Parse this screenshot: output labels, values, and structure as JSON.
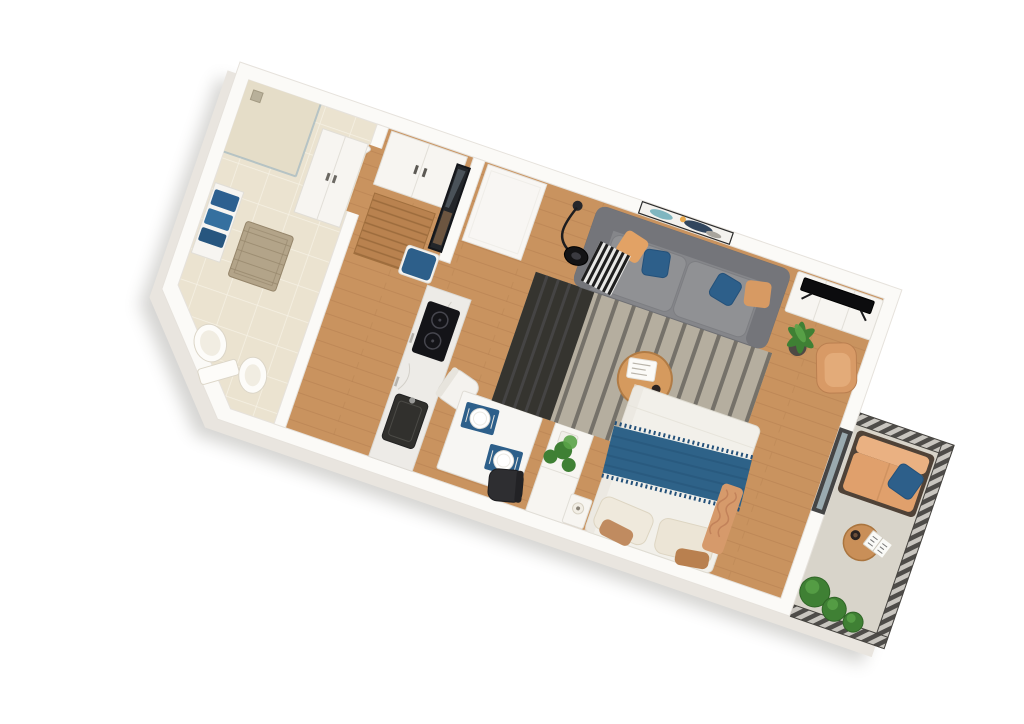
{
  "scene": {
    "description": "3D isometric floor plan render of a studio apartment with balcony",
    "rotation_deg": 19
  },
  "colors": {
    "page_bg": "#ffffff",
    "wall": "#fbfaf7",
    "wall_edge": "#e6e2dc",
    "wall_side": "#e9e5df",
    "wood": "#c9935f",
    "wood_dark": "#b17a4e",
    "tile": "#ebe3d0",
    "tile_line": "#f6f1e4",
    "shower": "#e5ddc8",
    "glass": "#a9bcc2",
    "rug_base": "#b5ae9f",
    "rug_stripe": "#6a665f",
    "rug_dark": "#35342f",
    "sofa": "#85868a",
    "sofa_dark": "#74757a",
    "seat": "#909194",
    "pillow_blue": "#2d5f8a",
    "pillow_orange": "#e2a265",
    "bed_white": "#f2f0ea",
    "pillow_beige": "#efe9dc",
    "pillow_brown": "#c08b60",
    "throw_blue": "#2e6288",
    "knit_tan": "#d69a6b",
    "tv_black": "#0c0c0e",
    "console_white": "#f7f5f1",
    "marble": "#edebe7",
    "cooktop": "#141418",
    "sink": "#31302d",
    "fridge": "#f8f6f3",
    "table_white": "#f7f6f3",
    "chair_black": "#2e2e31",
    "placemat_blue": "#2d5f8a",
    "mirror": "#23262a",
    "cushion_blue": "#2d5f8a",
    "mat_wood": "#b9824f",
    "mat_line": "#9c6b3c",
    "basket": "#b3a489",
    "towel_blue": "#2d6090",
    "balcony_floor": "#d8d4ca",
    "rail_dark": "#4e4c49",
    "rail_light": "#c9c6c0",
    "outdoor_sofa": "#e0a06c",
    "outdoor_back": "#eab182",
    "outdoor_frame": "#4f4237",
    "plant": "#3f8034",
    "plant_light": "#5aa348",
    "pot": "#4e4a44",
    "art_teal": "#7fb6c0",
    "art_navy": "#31465e",
    "art_orange": "#e8a94e",
    "art_gray": "#a8a49c",
    "lamp_black": "#131315",
    "door_frame": "#454545",
    "coffee_wood": "#d59a5e"
  },
  "rooms": {
    "bathroom": {
      "items": [
        "shower",
        "towel-shelf",
        "blue-towels",
        "laundry-basket",
        "storage-cabinet",
        "toilet",
        "bidet",
        "bathroom-door"
      ]
    },
    "hallway": {
      "items": [
        "wardrobe",
        "wall-mirror",
        "bench-with-blue-cushion",
        "wooden-door-mat"
      ]
    },
    "kitchen": {
      "items": [
        "fridge-tall-unit",
        "marble-counter",
        "induction-cooktop",
        "kitchen-sink"
      ]
    },
    "living_dining": {
      "items": [
        "dining-table",
        "blue-placemats-with-plates",
        "white-chair",
        "black-chair",
        "striped-rug",
        "gray-sofa",
        "accent-pillows",
        "checkered-throw",
        "arc-floor-lamp",
        "abstract-wall-art",
        "round-coffee-table",
        "magazines-and-cup",
        "tall-potted-plant",
        "divider-cabinet-with-plant"
      ]
    },
    "sleeping_area": {
      "items": [
        "tv-console",
        "flat-tv",
        "tan-armchair",
        "double-bed",
        "blue-throw-blanket",
        "beige-pillows",
        "tan-knit-blanket",
        "nightstand",
        "table-lamp",
        "balcony-door"
      ]
    },
    "balcony": {
      "items": [
        "slatted-railing",
        "outdoor-sofa",
        "blue-outdoor-pillow",
        "round-side-table",
        "coffee-cup",
        "open-book",
        "green-planters"
      ]
    }
  }
}
